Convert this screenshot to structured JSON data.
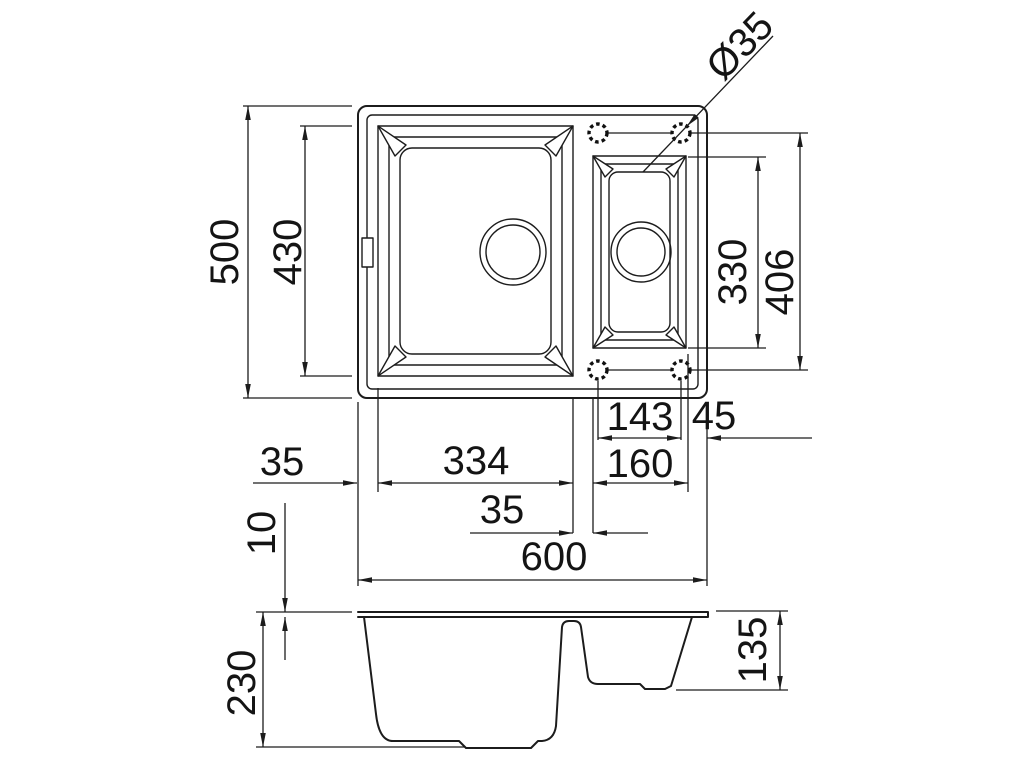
{
  "drawing": {
    "type": "sink-technical-drawing",
    "line_color": "#1c1c1c",
    "background": "#ffffff"
  },
  "labels": {
    "overall_depth": "500",
    "main_bowl_depth_dim": "430",
    "tap_hole_diameter": "Ø35",
    "small_bowl_inner_length": "330",
    "tap_rows_spacing": "406",
    "tap_holes_spacing": "143",
    "tap_edge_offset": "45",
    "left_margin": "35",
    "main_bowl_length": "334",
    "small_bowl_length": "160",
    "bowl_gap": "35",
    "overall_length": "600",
    "rim_height": "10",
    "main_bowl_depth": "230",
    "small_bowl_depth": "135"
  }
}
